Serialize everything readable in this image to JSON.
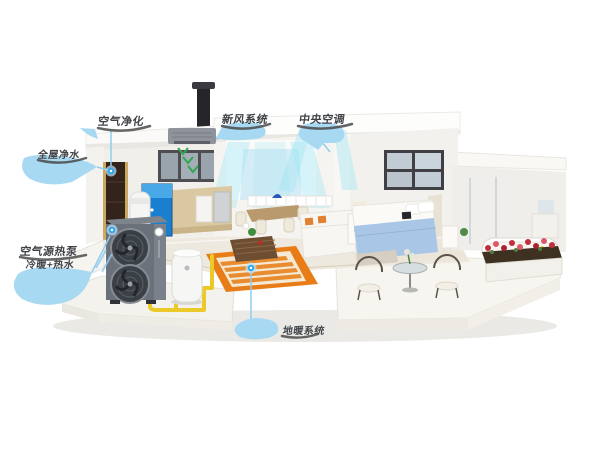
{
  "illustration": {
    "labels": {
      "air_purifier": "空气净化",
      "water_purification": "全屋净水",
      "fresh_air_system": "新风系统",
      "central_ac": "中央空调",
      "heat_pump_line1": "空气源热泵",
      "heat_pump_line2": "冷暖+热水",
      "floor_heating": "地暖系统"
    },
    "colors": {
      "label_bubble": "#a7d9f3",
      "label_text": "#3f4347",
      "pointer_blue": "#2fa9ee",
      "pointer_line": "#8fcdef",
      "pipe_yellow": "#ebc928",
      "floor_heating_orange": "#e87d18",
      "airflow_cyan": "#9fe4f2",
      "fresh_air_green": "#2fa84f",
      "heat_pump_gray": "#6b717a"
    }
  }
}
